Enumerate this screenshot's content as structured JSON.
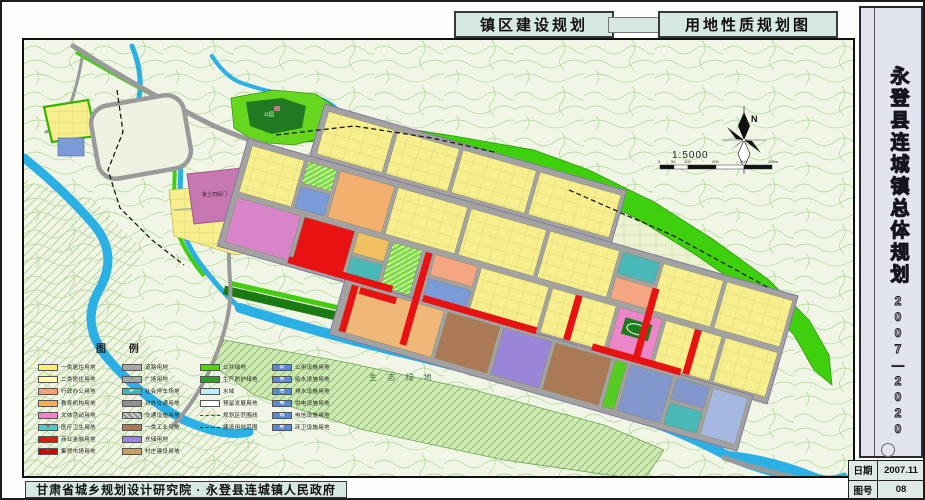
{
  "header": {
    "title_left": "镇区建设规划",
    "title_right": "用地性质规划图"
  },
  "sidebar": {
    "title": "永登县连城镇总体规划",
    "period": "2007—2020"
  },
  "footer": {
    "credit": "甘肃省城乡规划设计研究院 · 永登县连城镇人民政府",
    "date_label": "日期",
    "date_value": "2007.11",
    "sheet_label": "图号",
    "sheet_value": "08"
  },
  "map": {
    "north_label": "N",
    "scale_text": "1:5000",
    "scale_ticks": [
      "0",
      "50",
      "100",
      "200",
      "300",
      "400m"
    ],
    "labels": {
      "yamen": "鲁土司衙门",
      "eco_green": "生 态 绿 地",
      "park": "公园"
    },
    "legend": {
      "title": "图  例",
      "columns": [
        {
          "items": [
            {
              "t": "solid",
              "c": "#ffee70",
              "label": "一类居住用地"
            },
            {
              "t": "solid",
              "c": "#fff8ae",
              "label": "二类居住用地"
            },
            {
              "t": "solid",
              "c": "#f2a07a",
              "label": "行政办公用地"
            },
            {
              "t": "solid",
              "c": "#f5ae56",
              "label": "教育机构用地"
            },
            {
              "t": "solid",
              "c": "#ec86c8",
              "label": "文体活动用地"
            },
            {
              "t": "cross",
              "c": "#52c8c8",
              "label": "医疗卫生用地"
            },
            {
              "t": "solid",
              "c": "#e81414",
              "label": "商业金融用地"
            },
            {
              "t": "market",
              "c": "#d40000",
              "label": "集贸市场用地"
            }
          ]
        },
        {
          "items": [
            {
              "t": "solid",
              "c": "#a8a8a8",
              "label": "道路用地"
            },
            {
              "t": "plaza",
              "c": "#a8a8a8",
              "label": "广场用地"
            },
            {
              "t": "parking",
              "c": "#3cb8b8",
              "label": "社会停车场地"
            },
            {
              "t": "solid",
              "c": "#8f8f8f",
              "label": "对外交通用地"
            },
            {
              "t": "hatch",
              "c": "#c0c0c0",
              "label": "交通设施用地"
            },
            {
              "t": "solid",
              "c": "#a97a55",
              "label": "一类工业用地"
            },
            {
              "t": "solid",
              "c": "#9b85d8",
              "label": "仓储用地"
            },
            {
              "t": "solid",
              "c": "#c8a064",
              "label": "村庄建设用地"
            }
          ]
        },
        {
          "items": [
            {
              "t": "solid",
              "c": "#55d400",
              "label": "公共绿地"
            },
            {
              "t": "solid",
              "c": "#2ca02c",
              "label": "生产防护绿地"
            },
            {
              "t": "solid",
              "c": "#bfeef8",
              "label": "水域"
            },
            {
              "t": "solid",
              "c": "#ffffff",
              "label": "预留发展用地"
            },
            {
              "t": "line-red",
              "c": "#e00000",
              "label": "规划区范围线"
            },
            {
              "t": "line-black",
              "c": "#222222",
              "label": "建设用地范围"
            }
          ]
        },
        {
          "items": [
            {
              "t": "util",
              "c": "#5b8ad2",
              "g": "公",
              "label": "公用设施用地"
            },
            {
              "t": "util",
              "c": "#5b8ad2",
              "g": "水",
              "label": "给水设施用地"
            },
            {
              "t": "util",
              "c": "#5b8ad2",
              "g": "污",
              "label": "排水设施用地"
            },
            {
              "t": "util",
              "c": "#5b8ad2",
              "g": "电",
              "label": "供电设施用地"
            },
            {
              "t": "util",
              "c": "#5b8ad2",
              "g": "讯",
              "label": "电信设施用地"
            },
            {
              "t": "util",
              "c": "#5b8ad2",
              "g": "环",
              "label": "环卫设施用地"
            }
          ]
        }
      ]
    }
  },
  "palette": {
    "map_bg": "#f1f5e5",
    "water": "#2bb0e6",
    "green_belt": "#3fd00d",
    "panel_bg": "#d6e8e2",
    "sidebar_bg": "#e2e4f0"
  }
}
